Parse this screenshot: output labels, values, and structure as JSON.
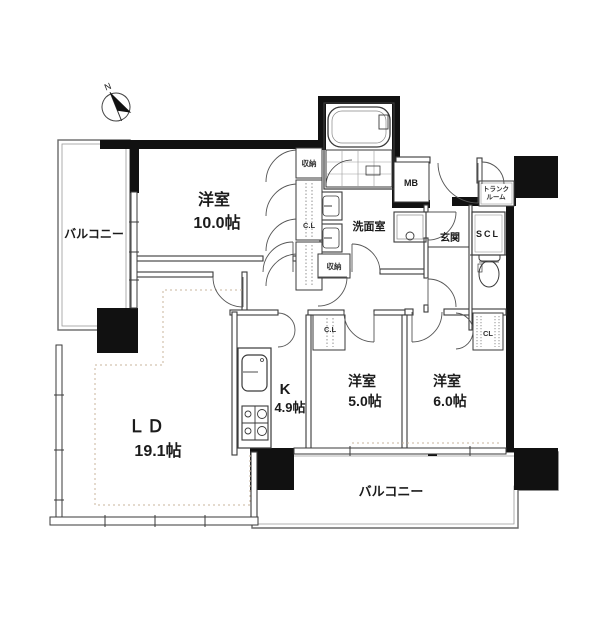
{
  "compass": {
    "north_label": "N"
  },
  "rooms": {
    "bedroom_10": {
      "name": "洋室",
      "size": "10.0帖"
    },
    "living_dining": {
      "name": "ＬＤ",
      "size": "19.1帖"
    },
    "kitchen": {
      "name": "K",
      "size": "4.9帖"
    },
    "bedroom_5": {
      "name": "洋室",
      "size": "5.0帖"
    },
    "bedroom_6": {
      "name": "洋室",
      "size": "6.0帖"
    },
    "washroom": {
      "name": "洗面室"
    },
    "entrance": {
      "name": "玄関"
    },
    "balcony_left": {
      "name": "バルコニー"
    },
    "balcony_bottom": {
      "name": "バルコニー"
    }
  },
  "storage": {
    "closet_bedroom10_top": {
      "label": "収納"
    },
    "closet_hall": {
      "label": "C.L"
    },
    "closet_washroom": {
      "label": "収納"
    },
    "meter_box": {
      "label": "MB"
    },
    "trunk_room": {
      "label_line1": "トランク",
      "label_line2": "ルーム"
    },
    "shoes_closet": {
      "label": "SCL"
    },
    "closet_bedroom5": {
      "label": "C.L"
    },
    "closet_bedroom6": {
      "label": "CL"
    }
  },
  "colors": {
    "wall": "#111111",
    "line": "#3a3a3a",
    "dotted_floor": "#c8b49e",
    "background": "#ffffff"
  }
}
